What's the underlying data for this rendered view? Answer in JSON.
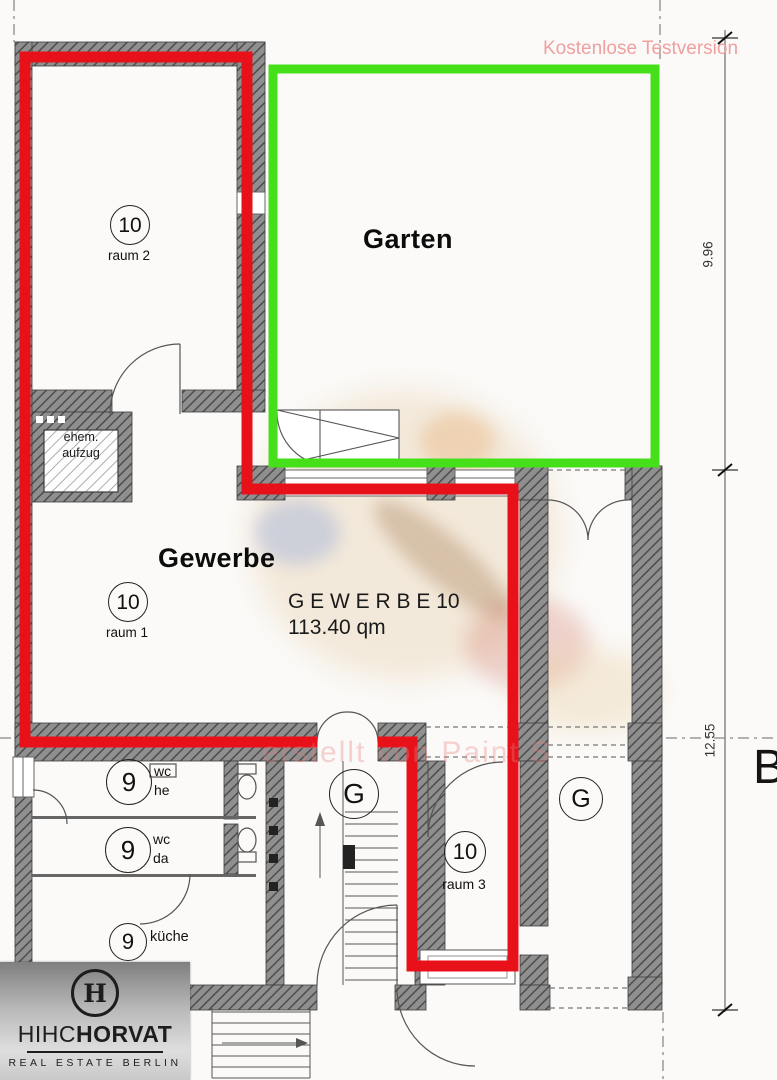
{
  "watermark": {
    "trial": "Kostenlose Testversion",
    "creator": "erstellt von Paint S"
  },
  "garten": {
    "title": "Garten"
  },
  "gewerbe": {
    "title": "Gewerbe",
    "unit_line1": "G E W E R B E  10",
    "unit_line2": "113.40 qm"
  },
  "aufzug": {
    "line1": "ehem.",
    "line2": "aufzug"
  },
  "badges": {
    "raum2": {
      "number": "10",
      "label": "raum 2"
    },
    "raum1": {
      "number": "10",
      "label": "raum 1"
    },
    "raum3": {
      "number": "10",
      "label": "raum 3"
    },
    "wc_he": {
      "number": "9",
      "line1": "wc",
      "line2": "he"
    },
    "wc_da": {
      "number": "9",
      "line1": "wc",
      "line2": "da"
    },
    "kueche": {
      "number": "9",
      "label": "küche"
    },
    "g_stair": {
      "letter": "G"
    },
    "g_room": {
      "letter": "G"
    }
  },
  "dimensions": {
    "upper": "9.96",
    "lower": "12.55",
    "section_letter": "B"
  },
  "logo": {
    "monogram": "H",
    "brand_light": "HIHC",
    "brand_bold": "HORVAT",
    "tagline": "REAL ESTATE BERLIN"
  },
  "colors": {
    "unit_outline": "#e8111a",
    "garden_outline": "#45e019",
    "watermark_pink": "#efa0a0",
    "watermark_creator": "rgba(228,125,125,0.38)"
  }
}
